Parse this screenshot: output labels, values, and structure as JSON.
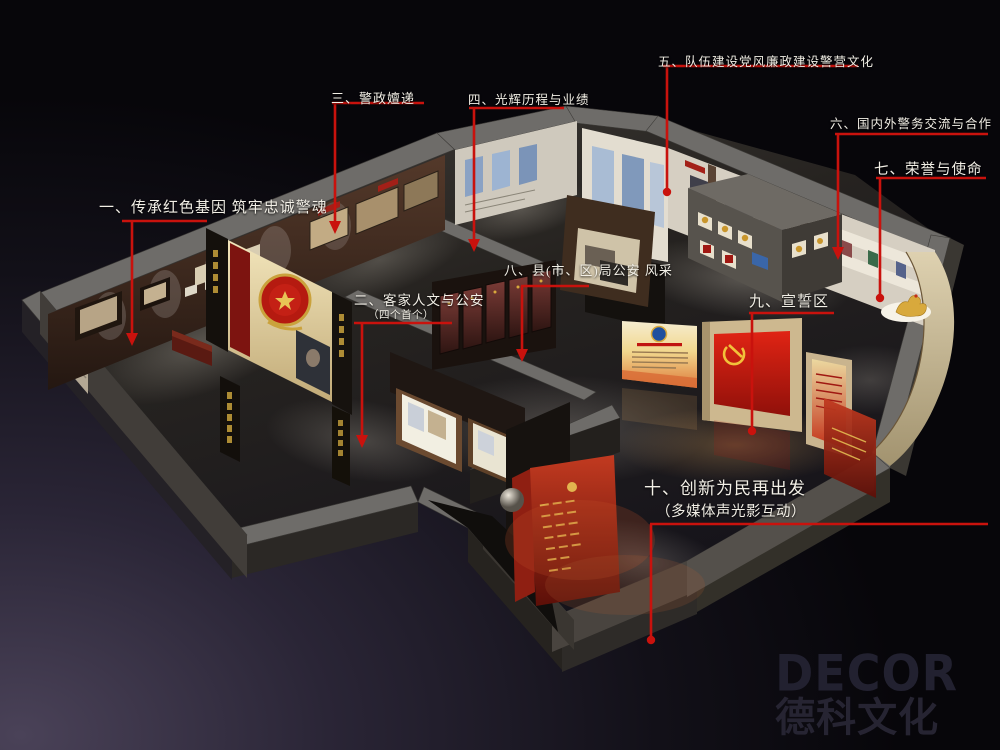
{
  "annotations": {
    "line_color": "#c9120d",
    "text_color": "#f2efe6",
    "zones": [
      {
        "label": "一、传承红色基因 筑牢忠诚警魂",
        "subtitle": ""
      },
      {
        "label": "二、客家人文与公安",
        "subtitle": "（四个首个）"
      },
      {
        "label": "三、警政嬗递",
        "subtitle": ""
      },
      {
        "label": "四、光辉历程与业绩",
        "subtitle": ""
      },
      {
        "label": "五、队伍建设党风廉政建设警营文化",
        "subtitle": ""
      },
      {
        "label": "六、国内外警务交流与合作",
        "subtitle": ""
      },
      {
        "label": "七、荣誉与使命",
        "subtitle": ""
      },
      {
        "label": "八、县(市、区)局公安 风采",
        "subtitle": ""
      },
      {
        "label": "九、宣誓区",
        "subtitle": ""
      },
      {
        "label": "十、创新为民再出发",
        "subtitle": "（多媒体声光影互动）"
      }
    ]
  },
  "logo": {
    "brand": "DECOR",
    "company": "德科文化"
  },
  "scene_colors": {
    "background_glow": "#4a4258",
    "wall_top_gray": "#6e6c69",
    "accent_red": "#c9120d",
    "flag_red": "#d71f10",
    "gold": "#d8a93c",
    "cream_wall": "#f0e3bb"
  }
}
